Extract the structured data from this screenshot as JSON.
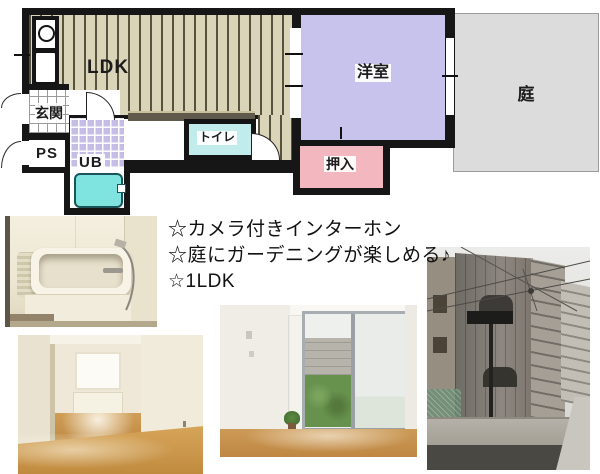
{
  "floorplan": {
    "rooms": {
      "ldk": "LDK",
      "genkan": "玄関",
      "ps": "PS",
      "ub": "UB",
      "toilet": "トイレ",
      "western_room": "洋室",
      "closet": "押入",
      "garden": "庭"
    },
    "colors": {
      "wall": "#161616",
      "ldk_floor": "#dad4b8",
      "ldk_stripe": "#57523e",
      "western_room": "#c7c3ed",
      "closet": "#f3b7c0",
      "toilet": "#c2ebec",
      "ub_tile": "#c6bde7",
      "bathtub": "#7fe3df",
      "garden": "#dcdcdc",
      "counter": "#605a4d"
    }
  },
  "features": {
    "line1": "☆カメラ付きインターホン",
    "line2": "☆庭にガーデニングが楽しめる♪",
    "line3": "☆1LDK"
  }
}
